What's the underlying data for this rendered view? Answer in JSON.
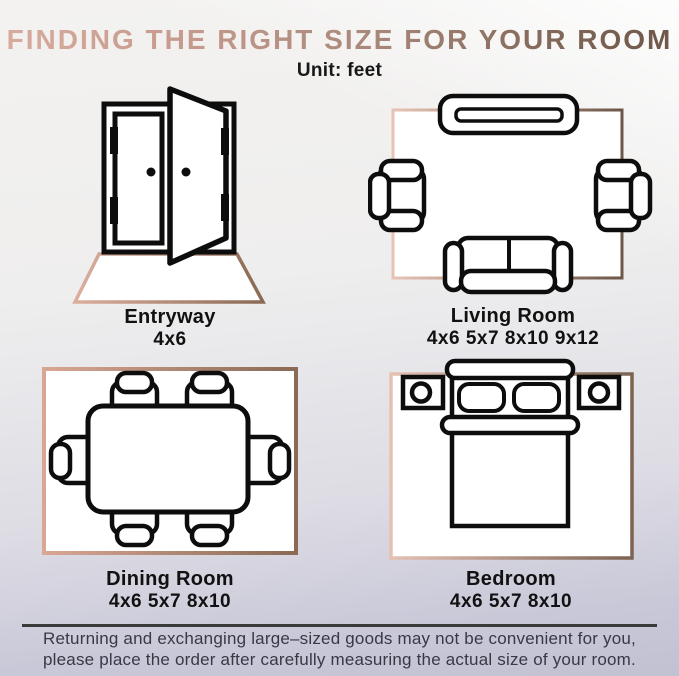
{
  "header": {
    "title": "FINDING THE RIGHT SIZE FOR YOUR ROOM",
    "unit_label": "Unit: feet"
  },
  "rooms": [
    {
      "name": "Entryway",
      "sizes": "4x6"
    },
    {
      "name": "Living Room",
      "sizes": "4x6 5x7 8x10 9x12"
    },
    {
      "name": "Dining Room",
      "sizes": "4x6 5x7 8x10"
    },
    {
      "name": "Bedroom",
      "sizes": "4x6 5x7 8x10"
    }
  ],
  "footer": {
    "line1": "Returning and exchanging large–sized goods may not be convenient for you,",
    "line2": "please place the order after carefully measuring the actual size of your room."
  },
  "icons": [
    "entryway-door-icon",
    "living-room-layout-icon",
    "dining-room-layout-icon",
    "bedroom-layout-icon"
  ],
  "colors": {
    "title_gradient_start": "#d8ab9e",
    "title_gradient_end": "#6d5749",
    "rug_gradient_start": "#ddb0a0",
    "rug_gradient_end": "#7c6351",
    "furniture_stroke": "#0d0d0d",
    "footer_text": "#393845",
    "background_top": "#f3f2f0",
    "background_bottom": "#c2c1d2",
    "divider": "#3a3a3a"
  }
}
